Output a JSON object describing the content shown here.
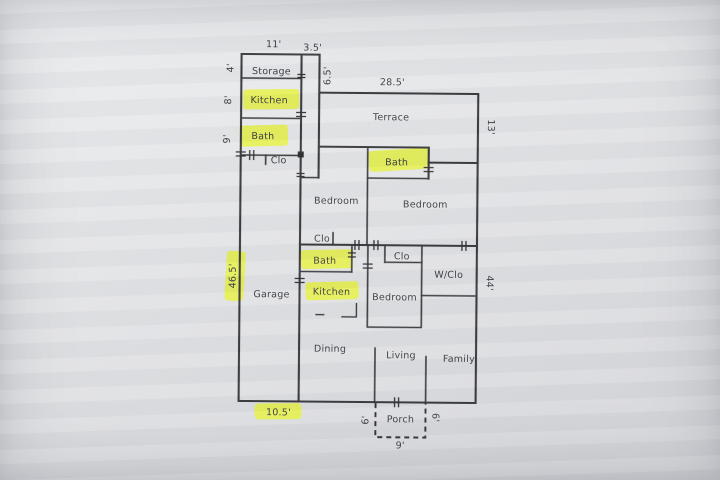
{
  "document_type": "scanned floor plan",
  "colors": {
    "highlight": "#e6f23c",
    "wall": "#38383c",
    "text": "#3b3b40",
    "paper": "#e4e5e7"
  },
  "rooms": {
    "storage": "Storage",
    "kitchen_left": "Kitchen",
    "bath_left": "Bath",
    "clo_left": "Clo",
    "terrace": "Terrace",
    "bath_top": "Bath",
    "bedroom_left": "Bedroom",
    "bedroom_right": "Bedroom",
    "clo_bedroom": "Clo",
    "bath_mid": "Bath",
    "kitchen_mid": "Kitchen",
    "clo_center": "Clo",
    "bedroom_center": "Bedroom",
    "wclo": "W/Clo",
    "garage": "Garage",
    "dining": "Dining",
    "living": "Living",
    "family": "Family",
    "porch": "Porch"
  },
  "dimensions": {
    "top_width": "11'",
    "top_offset": "3.5'",
    "terrace_side": "6.5'",
    "terrace_width": "28.5'",
    "right_upper": "13'",
    "right_lower": "44'",
    "storage_depth": "4'",
    "kitchen_depth": "8'",
    "bath_depth": "9'",
    "left_side": "46.5'",
    "garage_width": "10.5'",
    "porch_left": "6'",
    "porch_right": "6'",
    "porch_width": "9'"
  },
  "highlighted_labels": [
    "Kitchen (left)",
    "Bath (left)",
    "Bath (upper)",
    "Bath (middle)",
    "Kitchen (middle)",
    "46.5'",
    "10.5'"
  ]
}
